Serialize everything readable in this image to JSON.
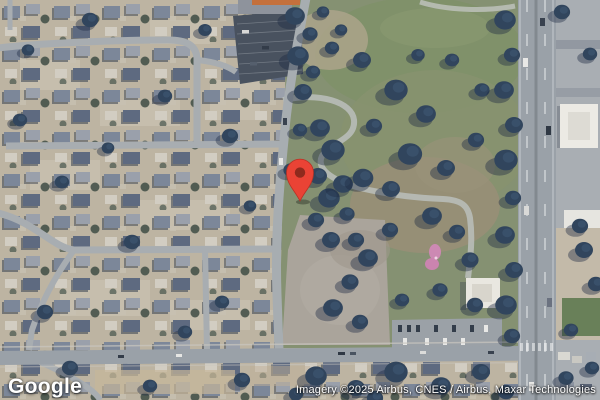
{
  "map": {
    "view_type": "satellite",
    "marker": {
      "name": "location-pin",
      "color": "#EA4335",
      "inner_color": "#8F2A1D"
    }
  },
  "footer": {
    "logo_text": "Google",
    "attribution": "Imagery ©2025 Airbus, CNES / Airbus, Maxar Technologies"
  }
}
